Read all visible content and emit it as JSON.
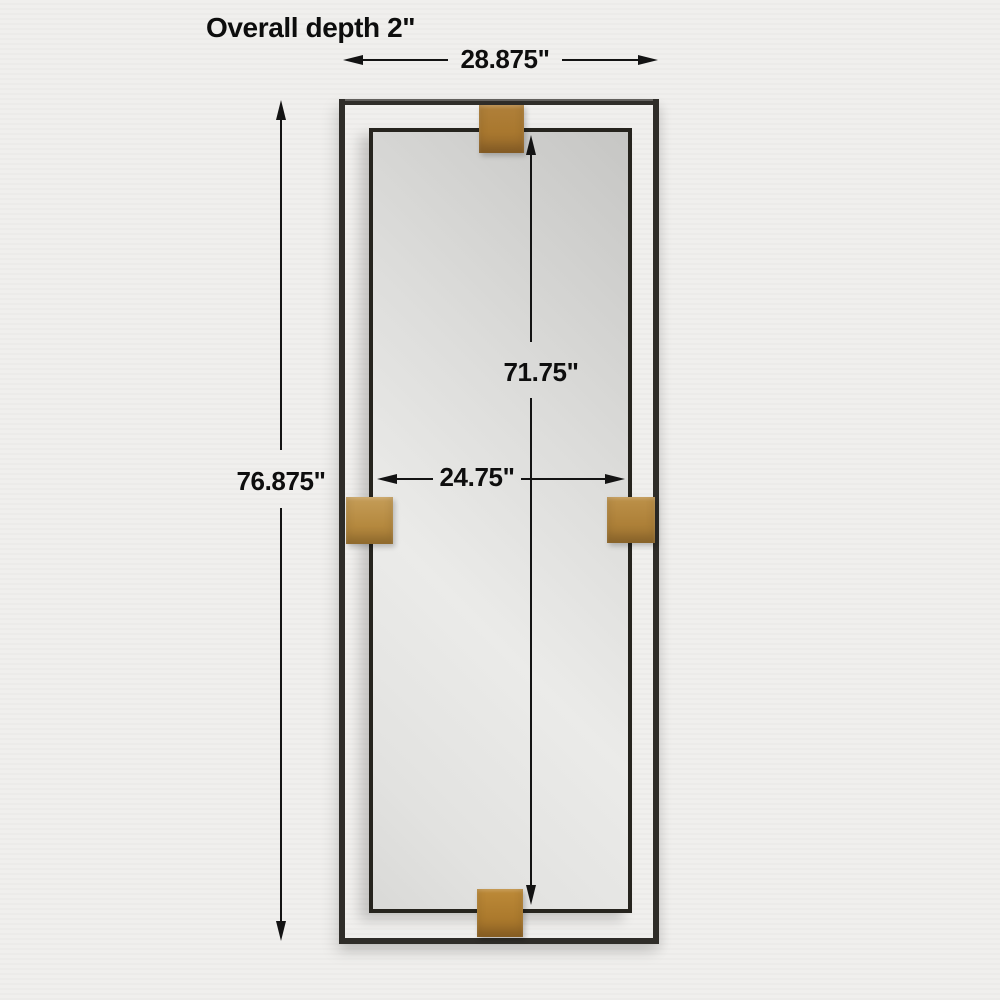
{
  "diagram": {
    "depth_label": "Overall depth 2\"",
    "dims": {
      "overall_width": "28.875\"",
      "overall_height": "76.875\"",
      "mirror_height": "71.75\"",
      "mirror_width": "24.75\""
    },
    "colors": {
      "background": "#f0efed",
      "frame": "#2f2d29",
      "brass_clip": "#ac7a2f",
      "mirror_glass": "#dcdcda",
      "dimension_line": "#131313"
    }
  }
}
